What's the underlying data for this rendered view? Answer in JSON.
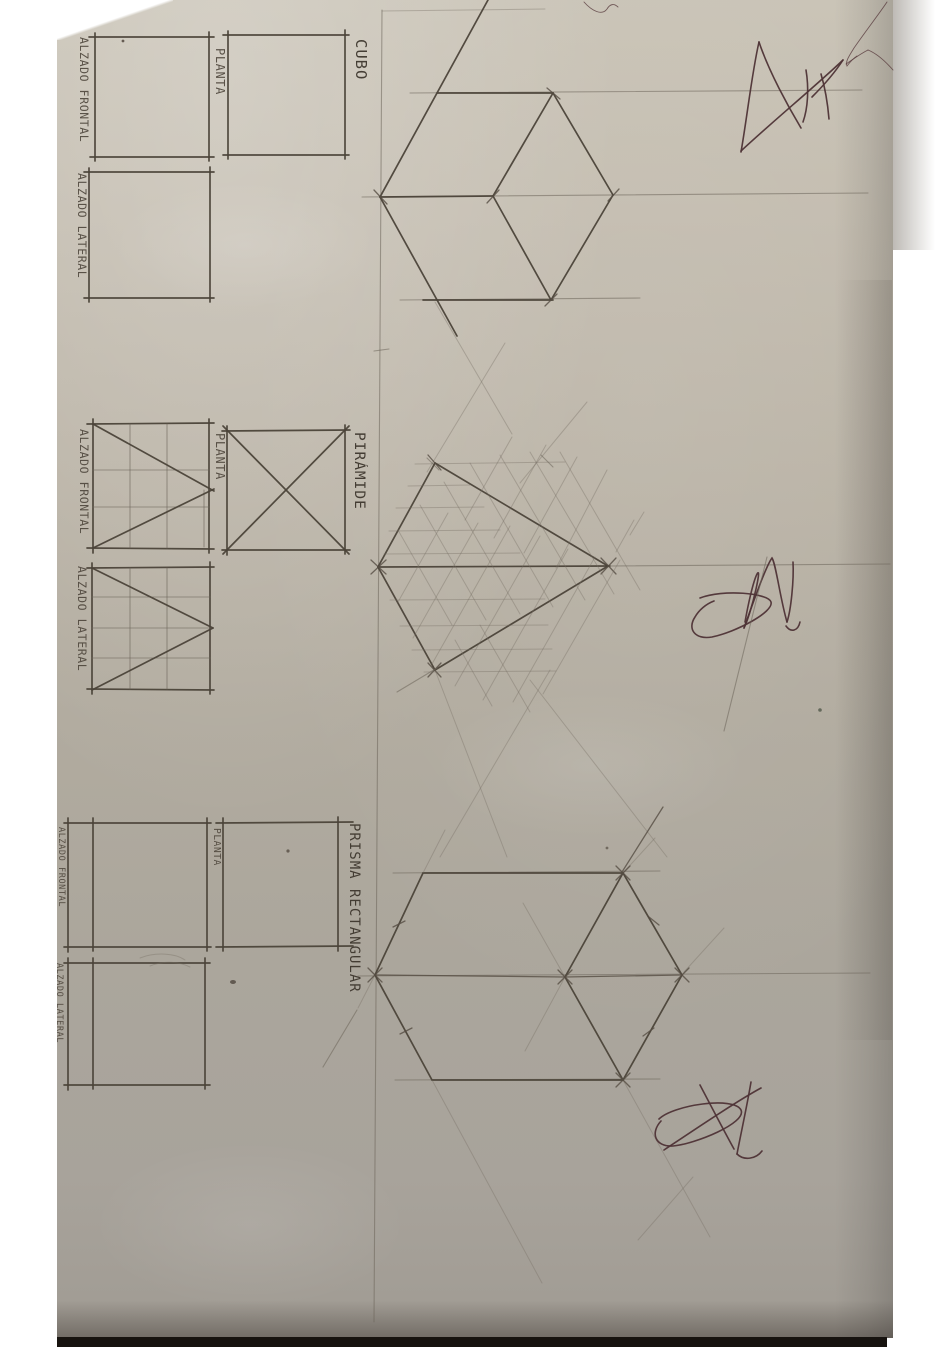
{
  "sections": {
    "cubo": {
      "title": "CUBO",
      "views": {
        "alzado_frontal": "ALZADO FRONTAL",
        "planta": "PLANTA",
        "alzado_lateral": "ALZADO LATERAL"
      }
    },
    "piramide": {
      "title": "PIRÁMIDE",
      "views": {
        "alzado_frontal": "ALZADO FRONTAL",
        "planta": "PLANTA",
        "alzado_lateral": "ALZADO LATERAL"
      }
    },
    "prisma": {
      "title": "PRISMA RECTANGULAR",
      "views": {
        "alzado_frontal": "ALZADO FRONTAL",
        "planta": "PLANTA",
        "alzado_lateral": "ALZADO LATERAL"
      }
    }
  },
  "colors": {
    "paper": "#b3ac9f",
    "pencil": "#4b4339",
    "pen_ink": "#4e3336",
    "background": "#ffffff",
    "table_shadow": "#17130f"
  },
  "marks": {
    "signatures": [
      "pen-signature-top-right",
      "pen-signature-middle-right",
      "pen-signature-bottom"
    ]
  }
}
